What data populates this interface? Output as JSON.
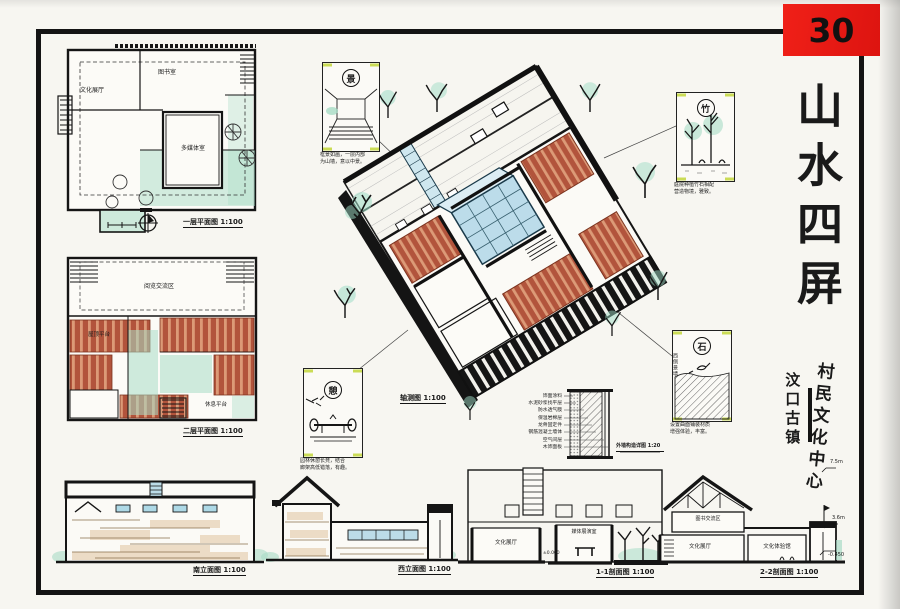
{
  "sheet": {
    "number": "30",
    "title": "山水四屏",
    "subtitle_left": "汶口古镇",
    "subtitle_right": "村民文化中心"
  },
  "plan1": {
    "caption": "一层平面图 1:100",
    "room_library": "图书室",
    "room_exhibition": "文化展厅",
    "room_media": "多媒体室"
  },
  "plan2": {
    "caption": "二层平面图 1:100",
    "room_reading": "阅览交流区",
    "room_terrace": "屋顶平台",
    "room_rest": "休息平台"
  },
  "axon": {
    "caption": "轴测图 1:100"
  },
  "details": {
    "view": {
      "tag": "景",
      "line1": "框景如画，一层内部",
      "line2": "为山墙，意以中景。"
    },
    "bamboo": {
      "tag": "竹",
      "line1": "庭院种植竹石相配",
      "line2": "营造物境，雅致。"
    },
    "stone": {
      "tag": "石",
      "line1": "设置曲面铺装材质",
      "line2": "增强体验，丰富。",
      "side": "西侧景墙"
    },
    "bench": {
      "tag": "憩",
      "line1": "园林休憩长凳，结合",
      "line2": "廊架高低错落，有趣。"
    }
  },
  "wall_detail": {
    "caption": "外墙构造详图 1:20",
    "layers": [
      "饰面涂料",
      "水泥砂浆找平层",
      "防水透气膜",
      "保温岩棉层",
      "龙骨固定件",
      "钢筋混凝土墙体",
      "空气间层",
      "木饰面板"
    ]
  },
  "elevation_south": {
    "caption": "南立面图 1:100"
  },
  "elevation_west": {
    "caption": "西立面图 1:100"
  },
  "section1": {
    "caption": "1-1剖面图 1:100",
    "room_left": "文化展厅",
    "room_mid": "媒体展演室",
    "level": "±0.000"
  },
  "section2": {
    "caption": "2-2剖面图 1:100",
    "room_top": "图书交流区",
    "room_left": "文化展厅",
    "room_right": "文化体验馆",
    "level_top": "7.5m",
    "level_mid": "3.6m",
    "level_bottom": "-0.450"
  },
  "colors": {
    "accent_red": "#ea1c16",
    "terracotta": "#b2543c",
    "mint": "#a8dcc6",
    "glass_blue": "#bfdde9",
    "ink": "#161616",
    "paper": "#f7f6f1"
  }
}
